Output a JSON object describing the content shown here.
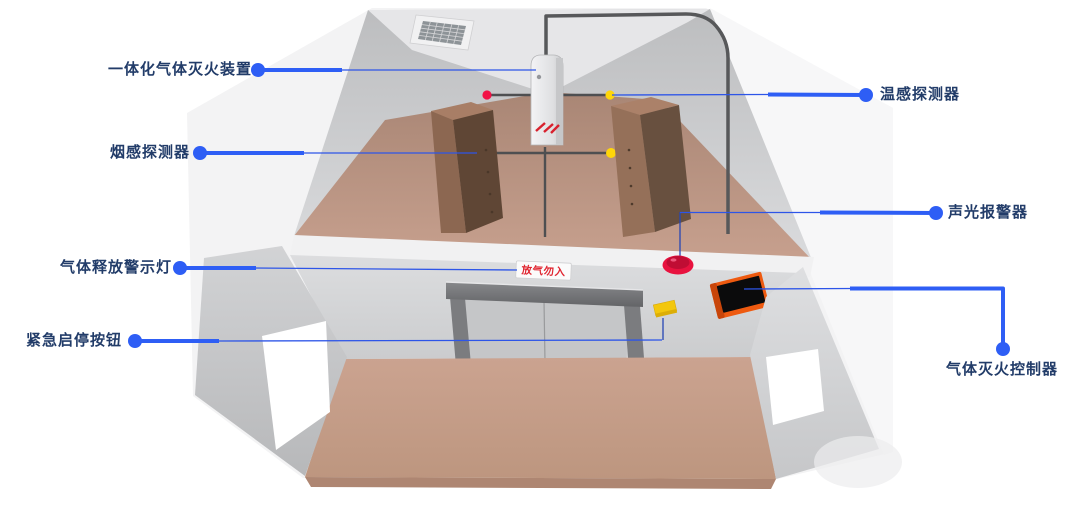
{
  "diagram": {
    "labels": {
      "integrated_unit": "一体化气体灭火装置",
      "smoke_detector": "烟感探测器",
      "gas_release_warning_light": "气体释放警示灯",
      "emergency_button": "紧急启停按钮",
      "heat_detector": "温感探测器",
      "sound_light_alarm": "声光报警器",
      "gas_controller": "气体灭火控制器"
    },
    "sign": {
      "text": "放气勿入"
    },
    "colors": {
      "leader_blue": "#2e5ef5",
      "leader_thin_blue": "#2d55e8",
      "connector_navy": "#2646b4",
      "label_navy": "#223c69",
      "sign_red": "#e02530",
      "alarm_dome_red": "#e8123f",
      "detector_red": "#f21246",
      "detector_yellow": "#ffd60a",
      "panel_orange": "#ee5a10",
      "button_yellow": "#f3c70d",
      "floor_tan": "#c49e8c",
      "wall_gray": "#c7c8ca"
    }
  }
}
